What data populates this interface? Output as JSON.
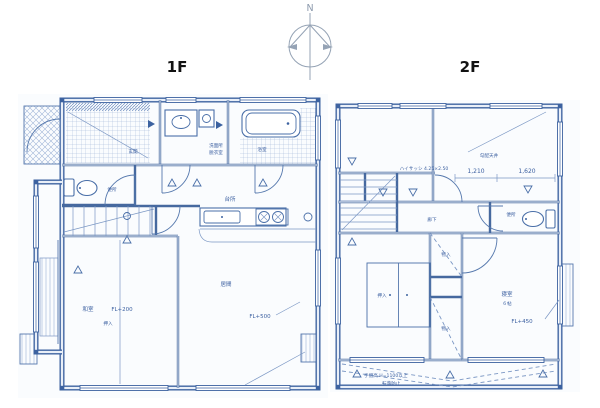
{
  "meta": {
    "compass_label": "N",
    "ink_color": "#3c62a0",
    "hatch_color": "#9db3d6",
    "paper_color": "#ffffff"
  },
  "floor1": {
    "title": "1F",
    "rooms": {
      "genkan": "玄関",
      "toilet": "便所",
      "washroom_line1": "洗面所",
      "washroom_line2": "脱衣室",
      "bath": "浴室",
      "kitchen": "台所",
      "living": "居間",
      "tatami": "和室",
      "closet": "押入"
    },
    "annotations": {
      "tatami_floor_level": "FL+200",
      "living_floor_level": "FL+500"
    }
  },
  "floor2": {
    "title": "2F",
    "rooms": {
      "hall": "廊下",
      "toilet": "便所",
      "bedroom": "寝室",
      "bedroom_size": "６帖",
      "closet_upper": "物入",
      "closet_lower": "物入",
      "oshiire": "押入"
    },
    "annotations": {
      "sash_note": "ハイサッシ 4.25×2.50",
      "ceiling_note": "勾配天井",
      "dim_left": "1,210",
      "dim_right": "1,620",
      "bedroom_floor_level": "FL+450",
      "rail_note_line1": "手摺高 H=1100以上",
      "rail_note_line2": "転落防止"
    }
  }
}
